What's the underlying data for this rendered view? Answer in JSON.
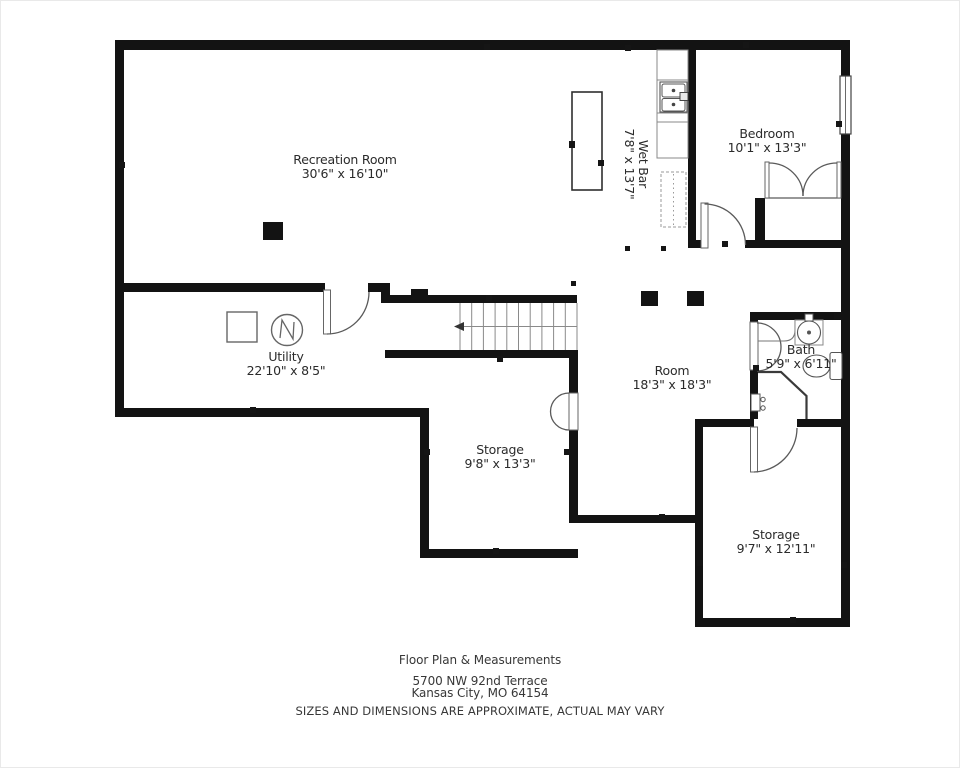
{
  "colors": {
    "background": "#ffffff",
    "walls": "#131313",
    "thin_lines": "#666666",
    "text": "#2b2b2b"
  },
  "rooms": [
    {
      "name": "Recreation Room",
      "dimensions": "30'6\" x 16'10\""
    },
    {
      "name": "Wet Bar",
      "dimensions": "7'8\" x 13'7\""
    },
    {
      "name": "Bedroom",
      "dimensions": "10'1\" x 13'3\""
    },
    {
      "name": "Utility",
      "dimensions": "22'10\" x 8'5\""
    },
    {
      "name": "Room",
      "dimensions": "18'3\" x 18'3\""
    },
    {
      "name": "Bath",
      "dimensions": "5'9\" x 6'11\""
    },
    {
      "name": "Storage",
      "dimensions": "9'8\" x 13'3\""
    },
    {
      "name": "Storage",
      "dimensions": "9'7\" x 12'11\""
    }
  ],
  "fixture_icons": [
    "stairs",
    "stairs-direction-arrow",
    "kitchen-island",
    "wet-bar-sink",
    "dishwasher",
    "furnace",
    "water-heater",
    "bedroom-window",
    "bedroom-closet-doors",
    "vanity-sink",
    "toilet",
    "shower",
    "support-post",
    "door-swing"
  ],
  "footer": {
    "title": "Floor Plan & Measurements",
    "address_line1": "5700 NW 92nd Terrace",
    "address_line2": "Kansas City, MO 64154",
    "disclaimer": "SIZES AND DIMENSIONS ARE APPROXIMATE, ACTUAL MAY VARY"
  }
}
